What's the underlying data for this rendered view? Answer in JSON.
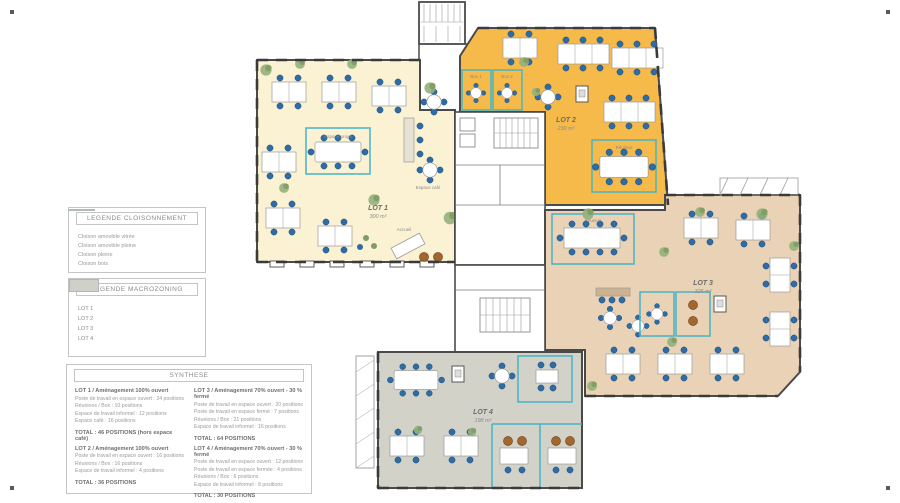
{
  "legend_cloisonnement": {
    "title": "LEGENDE CLOISONNEMENT",
    "items": [
      {
        "label": "Cloison amovible vitrée",
        "color": "#4fb5c6"
      },
      {
        "label": "Cloison amovible pleine",
        "color": "#5a4636"
      },
      {
        "label": "Cloison pleine",
        "color": "#5d9b6c"
      },
      {
        "label": "Cloison bois",
        "color": "#c8c8c8"
      }
    ]
  },
  "legend_macrozoning": {
    "title": "LEGENDE MACROZONING",
    "items": [
      {
        "label": "LOT 1",
        "color": "#fbf1d3"
      },
      {
        "label": "LOT 2",
        "color": "#f6ba4a"
      },
      {
        "label": "LOT 3",
        "color": "#e6cba6"
      },
      {
        "label": "LOT 4",
        "color": "#cfd0c7"
      }
    ]
  },
  "synthese": {
    "title": "SYNTHESE",
    "blocks": [
      {
        "title": "LOT 1 / Aménagement 100% ouvert",
        "lines": [
          "Poste de travail en espace ouvert : 24 positions",
          "Réunions / Box : 10 positions",
          "Espace de travail informel : 12 positions",
          "Espace café : 16 positions"
        ],
        "total": "TOTAL : 46 POSITIONS (hors espace café)"
      },
      {
        "title": "LOT 2 / Aménagement 100% ouvert",
        "lines": [
          "Poste de travail en espace ouvert : 16 positions",
          "Réunions / Box : 16 positions",
          "Espace de travail informel : 4 positions"
        ],
        "total": "TOTAL : 36 POSITIONS"
      },
      {
        "title": "LOT 3 / Aménagement 70% ouvert - 30 % fermé",
        "lines": [
          "Poste de travail en espace ouvert : 20 positions",
          "Poste de travail en espace fermé : 7 positions",
          "Réunions / Box : 21 positions",
          "Espace de travail informel : 16 positions"
        ],
        "total": "TOTAL : 64 POSITIONS"
      },
      {
        "title": "LOT 4 / Aménagement 70% ouvert - 30 % fermé",
        "lines": [
          "Poste de travail en espace ouvert : 12 positions",
          "Poste de travail en espace fermée : 4 positions",
          "Réunions / Box : 6 positions",
          "Espace de travail informel : 8 positions"
        ],
        "total": "TOTAL : 30 POSITIONS"
      }
    ]
  },
  "plan": {
    "lots": [
      {
        "label": "LOT 1",
        "area": "300 m²",
        "color": "#fbf1d3"
      },
      {
        "label": "LOT 2",
        "area": "230 m²",
        "color": "#f6ba4a"
      },
      {
        "label": "LOT 3",
        "area": "325 m²",
        "color": "#ead2b6"
      },
      {
        "label": "LOT 4",
        "area": "198 m²",
        "color": "#d2d2c9"
      }
    ],
    "rooms": {
      "accueil": "Accueil",
      "espace_cafe": "Espace café",
      "espace_projet": "Espace projet",
      "box1": "Box 1",
      "box2": "Box 2",
      "reunion": "Réunion"
    }
  }
}
